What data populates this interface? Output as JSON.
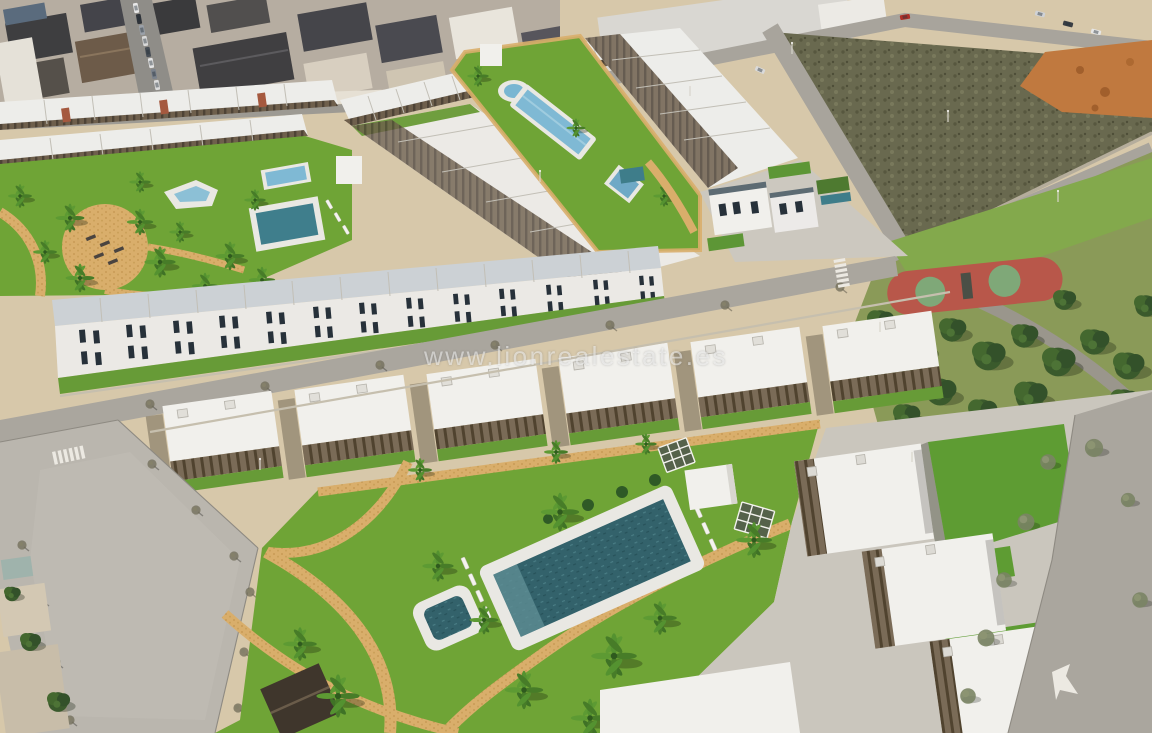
{
  "image": {
    "kind": "aerial-3d-render",
    "description": "Aerial 3D render of a new-build white residential development with communal pools, lawns, tan paths and palm trees, next to an existing town, a vacant scrub plot, roads and a public park with a red playground.",
    "watermark": "www.lionrealestate.es"
  },
  "palette": {
    "grass": "#6fa436",
    "grass_front": "#679b37",
    "grass_bright": "#5e9c33",
    "park_grass": "#8a9a58",
    "park_lawn": "#83a94c",
    "scrub": "#69694f",
    "orange_dirt": "#c0793f",
    "sand": "#d7c8aa",
    "town_base": "#b6ada1",
    "road": "#aaa69e",
    "boulevard": "#bab6ae",
    "path_tan": "#d9ae6b",
    "pool_teal": "#33626b",
    "pool_teal_deep": "#3f7e8c",
    "pool_blue": "#7fb9d4",
    "playground_red": "#b8574a",
    "playground_green": "#7fa878",
    "building_white": "#f1f0ec",
    "roof_pale": "#ccd1d5",
    "pergola_brown": "#6e5f4c",
    "tree_green": "#3a5a2c",
    "dark_roof": "#413830"
  }
}
